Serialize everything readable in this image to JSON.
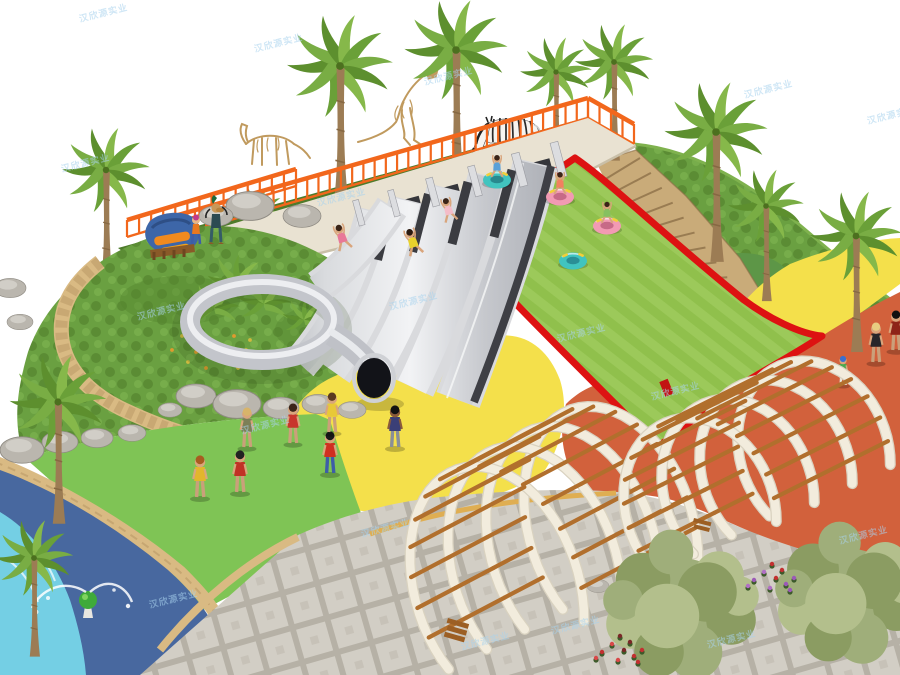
{
  "watermark": {
    "text": "汉欣源实业",
    "color": "#a9d3ee"
  },
  "palette": {
    "railing": "#f2671c",
    "wallBeige": "#e9e2d2",
    "lawn": "#9cc95a",
    "lawnStripe": "#8dbd4b",
    "hill": "#6a9d41",
    "hillDark": "#577f31",
    "ridge": "#4e7b2b",
    "red": "#dd1212",
    "yellow": "#f4e04b",
    "orange": "#d2613c",
    "greenRubber": "#7fc455",
    "deckBlue": "#48689f",
    "water": "#74cfe4",
    "sand": "#d9ba83",
    "stone": "#c9ab79",
    "plazaGrout": "#b6b1a6",
    "plazaTile": "#d2cec5",
    "wood": "#b16f2d",
    "rib": "#f2ecdd",
    "rock": "#bab6ae",
    "trunk": "#9c7c54",
    "palmDark": "#5d8f2e",
    "palmLight": "#79ad44",
    "skeleton": "#c09a5e",
    "steelLight": "#f2f3f5",
    "steelMid": "#c3c5cb",
    "steelDark": "#3e3f45",
    "tubeTeal": "#41c4bf",
    "tubePink": "#f29ab3",
    "handleYellow": "#f2cf3a",
    "signBlue": "#3d66a8",
    "signOrange": "#f08a1e",
    "treeA": "#9fae7a",
    "treeB": "#8b9c62",
    "treeC": "#b3bf8c"
  }
}
